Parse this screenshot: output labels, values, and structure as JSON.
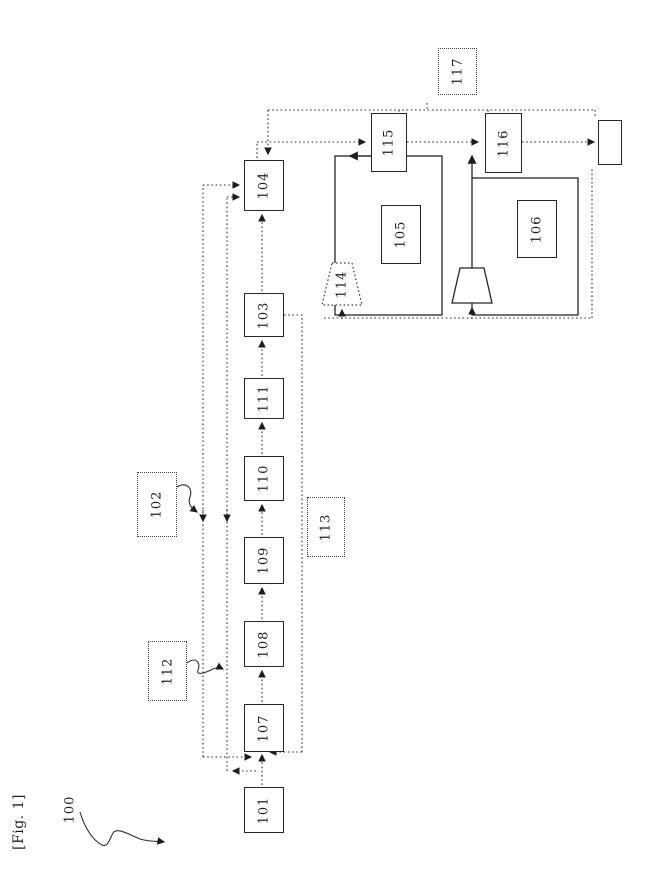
{
  "ink": "#1d1d1d",
  "background": "#ffffff",
  "figure": {
    "tag": "[Fig. 1]",
    "overall_ref": "100"
  },
  "nodes": {
    "n101": "101",
    "n102": "102",
    "n103": "103",
    "n104": "104",
    "n105": "105",
    "n106": "106",
    "n107": "107",
    "n108": "108",
    "n109": "109",
    "n110": "110",
    "n111": "111",
    "n112": "112",
    "n113": "113",
    "n114": "114",
    "n115": "115",
    "n116": "116",
    "n117": "117"
  }
}
